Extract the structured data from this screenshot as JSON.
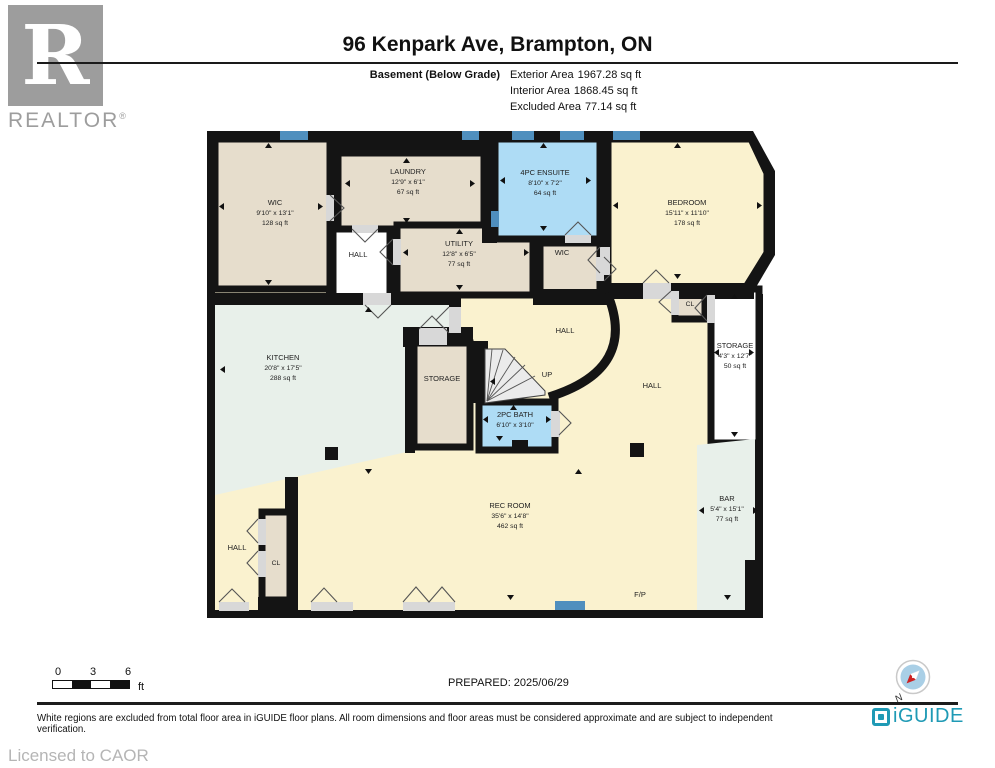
{
  "header": {
    "logo_r": "R",
    "brand": "REALTOR",
    "brand_reg": "®",
    "title": "96 Kenpark Ave, Brampton, ON",
    "floor_label": "Basement (Below Grade)",
    "areas": [
      {
        "label": "Exterior Area",
        "value": "1967.28 sq ft"
      },
      {
        "label": "Interior Area",
        "value": "1868.45 sq ft"
      },
      {
        "label": "Excluded Area",
        "value": "77.14 sq ft"
      }
    ]
  },
  "rooms": {
    "wic": {
      "name": "WIC",
      "dims": "9'10\" x 13'1\"",
      "area": "128 sq ft"
    },
    "laundry": {
      "name": "LAUNDRY",
      "dims": "12'9\" x 6'1\"",
      "area": "67 sq ft"
    },
    "hall_top": {
      "name": "HALL"
    },
    "utility": {
      "name": "UTILITY",
      "dims": "12'8\" x 6'5\"",
      "area": "77 sq ft"
    },
    "ensuite": {
      "name": "4PC ENSUITE",
      "dims": "8'10\" x 7'2\"",
      "area": "64 sq ft"
    },
    "wic_small": {
      "name": "WIC"
    },
    "bedroom": {
      "name": "BEDROOM",
      "dims": "15'11\" x 11'10\"",
      "area": "178 sq ft"
    },
    "cl_right": {
      "name": "CL"
    },
    "storage_right": {
      "name": "STORAGE",
      "dims": "4'3\" x 12'7\"",
      "area": "50 sq ft"
    },
    "kitchen": {
      "name": "KITCHEN",
      "dims": "20'8\" x 17'5\"",
      "area": "288 sq ft"
    },
    "storage_mid": {
      "name": "STORAGE"
    },
    "hall_mid": {
      "name": "HALL"
    },
    "hall_center": {
      "name": "HALL"
    },
    "stairs": {
      "name": "UP"
    },
    "bath": {
      "name": "2PC BATH",
      "dims": "6'10\" x 3'10\""
    },
    "rec": {
      "name": "REC ROOM",
      "dims": "35'6\" x 14'8\"",
      "area": "462 sq ft"
    },
    "bar": {
      "name": "BAR",
      "dims": "5'4\" x 15'1\"",
      "area": "77 sq ft"
    },
    "hall_bottom": {
      "name": "HALL"
    },
    "cl_bottom": {
      "name": "CL"
    },
    "fireplace": {
      "name": "F/P"
    }
  },
  "footer": {
    "scale": {
      "t0": "0",
      "t1": "3",
      "t2": "6",
      "unit": "ft"
    },
    "prepared": "PREPARED: 2025/06/29",
    "compass_n": "N",
    "disclaimer": "White regions are excluded from total floor area in iGUIDE floor plans. All room dimensions and floor areas must be considered approximate and are subject to independent verification.",
    "brand": "iGUIDE",
    "licensed": "Licensed to CAOR"
  },
  "colors": {
    "wall": "#141414",
    "room_beige": "#e6ddcc",
    "room_cream": "#faf2cf",
    "room_mint": "#e8f0ea",
    "room_blue": "#aedcf5",
    "room_excluded": "#ffffff",
    "window_blue": "#4f8fbe",
    "iguide_teal": "#1f9ab5",
    "logo_gray": "#9d9d9d"
  }
}
